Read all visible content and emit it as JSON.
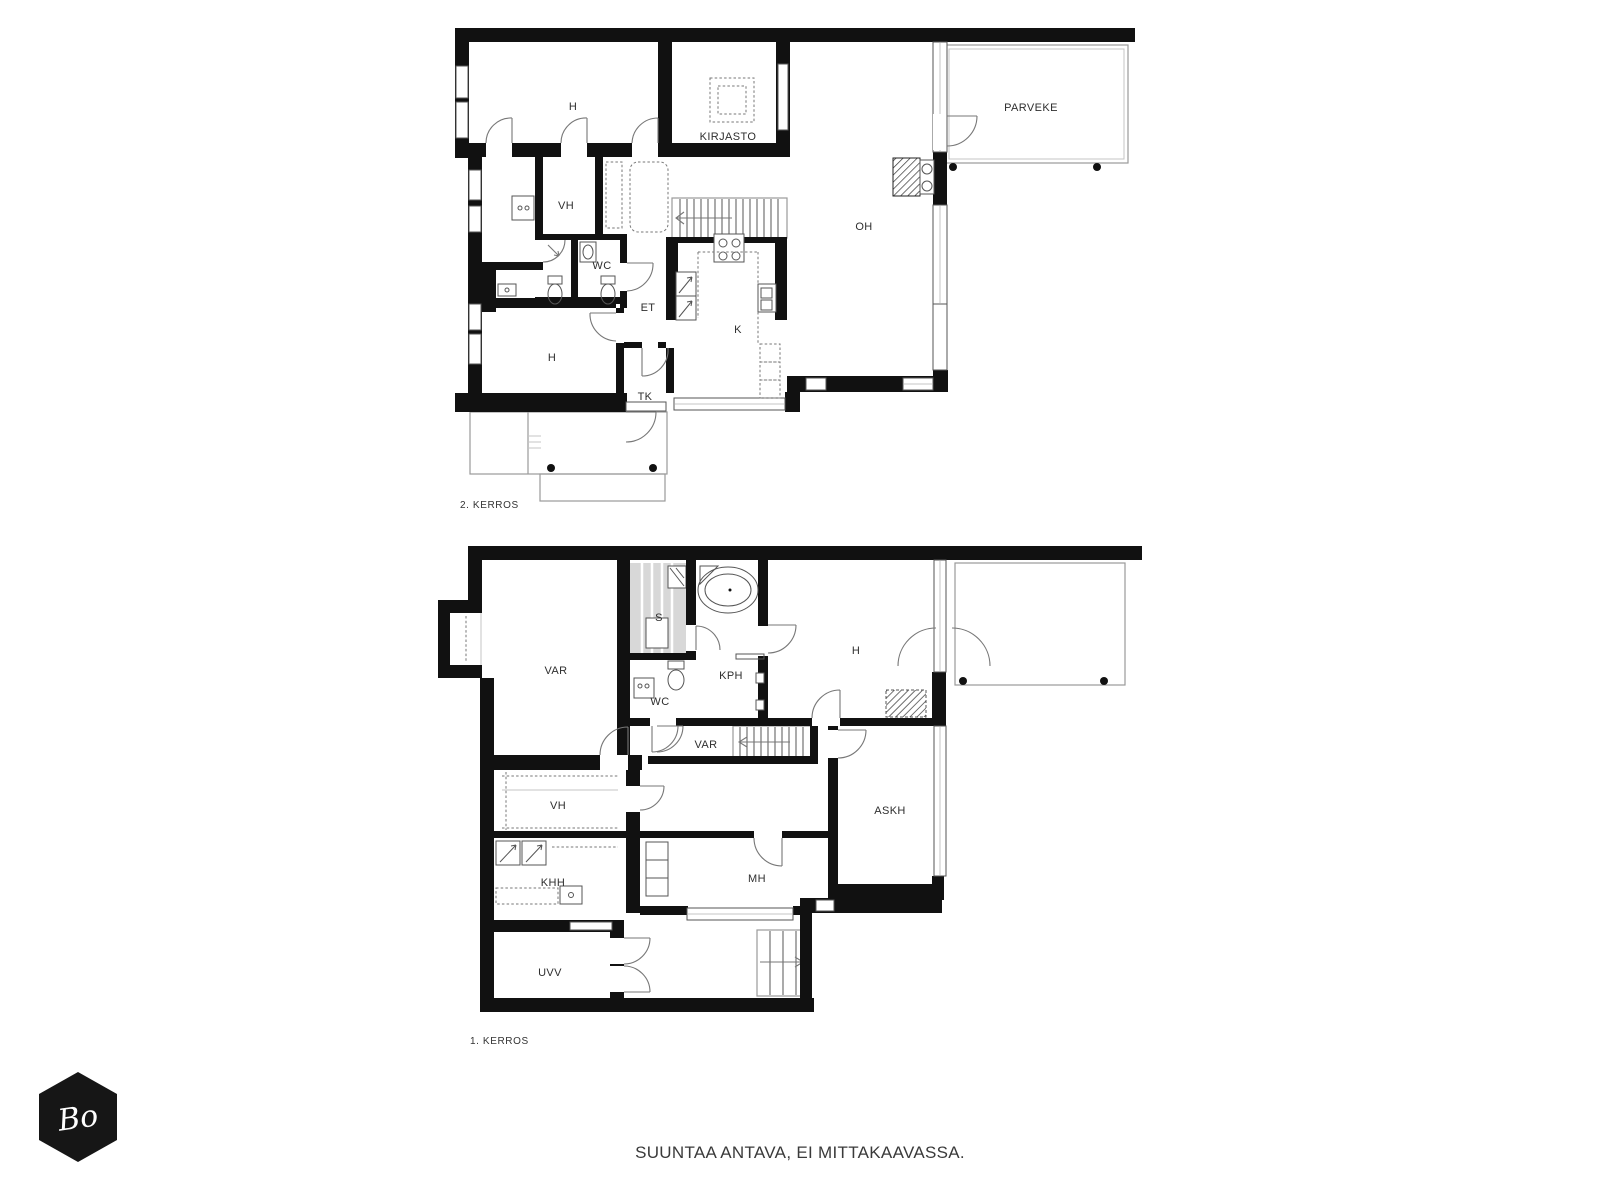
{
  "page": {
    "background": "#ffffff"
  },
  "footer": {
    "disclaimer": "SUUNTAA ANTAVA, EI MITTAKAAVASSA."
  },
  "logo": {
    "text": "Bo"
  },
  "colors": {
    "wall": "#111111",
    "thin_line": "#9a9a9a",
    "door_arc": "#777777",
    "text": "#2e2e2e",
    "logo_bg": "#161616"
  },
  "floors": [
    {
      "name": "2. KERROS",
      "rooms": [
        {
          "label": "H"
        },
        {
          "label": "KIRJASTO"
        },
        {
          "label": "PARVEKE"
        },
        {
          "label": "VH"
        },
        {
          "label": "WC"
        },
        {
          "label": "ET"
        },
        {
          "label": "K"
        },
        {
          "label": "OH"
        },
        {
          "label": "H"
        },
        {
          "label": "TK"
        }
      ]
    },
    {
      "name": "1. KERROS",
      "rooms": [
        {
          "label": "VAR"
        },
        {
          "label": "S"
        },
        {
          "label": "KPH"
        },
        {
          "label": "WC"
        },
        {
          "label": "H"
        },
        {
          "label": "VAR"
        },
        {
          "label": "VH"
        },
        {
          "label": "ASKH"
        },
        {
          "label": "KHH"
        },
        {
          "label": "MH"
        },
        {
          "label": "UVV"
        }
      ]
    }
  ]
}
